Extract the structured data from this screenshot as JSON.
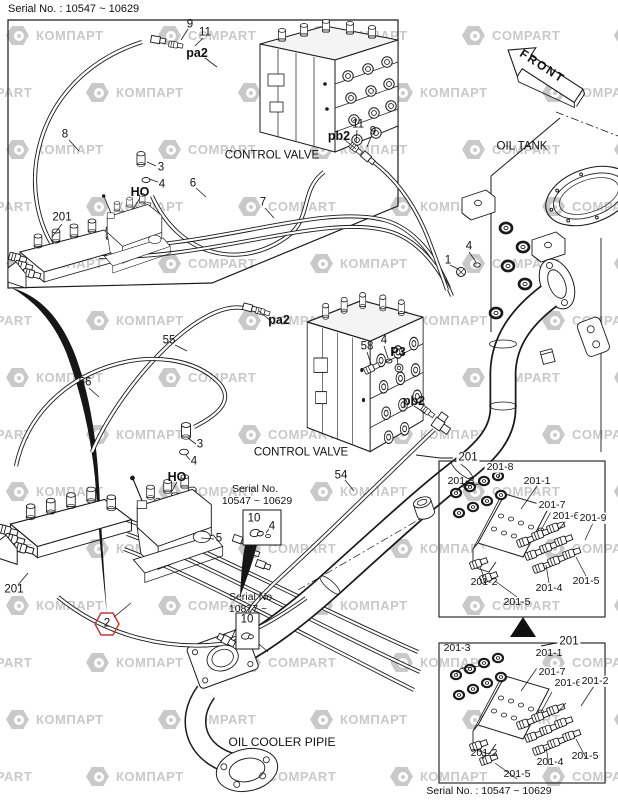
{
  "header": {
    "serial_top": "Serial No. : 10547 ~ 10629"
  },
  "front_arrow": {
    "label": "FRONT"
  },
  "watermark": {
    "words": [
      "КОМПАРТ",
      "COMPART"
    ],
    "color": "#c9c9c9"
  },
  "callouts": [
    {
      "name": "num-9-top",
      "text": "9",
      "x": 190,
      "y": 25
    },
    {
      "name": "num-11-top",
      "text": "11",
      "x": 205,
      "y": 33
    },
    {
      "name": "port-pa2-top",
      "text": "pa2",
      "x": 197,
      "y": 53,
      "b": 1
    },
    {
      "name": "num-8",
      "text": "8",
      "x": 65,
      "y": 135
    },
    {
      "name": "num-3-top",
      "text": "3",
      "x": 161,
      "y": 168
    },
    {
      "name": "num-4-top",
      "text": "4",
      "x": 162,
      "y": 185
    },
    {
      "name": "port-ho-top",
      "text": "HO",
      "x": 140,
      "y": 192,
      "b": 1
    },
    {
      "name": "num-6",
      "text": "6",
      "x": 193,
      "y": 184
    },
    {
      "name": "label-control-valve-top",
      "text": "CONTROL VALVE",
      "x": 272,
      "y": 156
    },
    {
      "name": "num-7",
      "text": "7",
      "x": 263,
      "y": 203
    },
    {
      "name": "num-201-top",
      "text": "201",
      "x": 62,
      "y": 218
    },
    {
      "name": "port-pb2-top",
      "text": "pb2",
      "x": 339,
      "y": 136,
      "b": 1
    },
    {
      "name": "num-11-top2",
      "text": "11",
      "x": 358,
      "y": 125
    },
    {
      "name": "num-9-top2",
      "text": "9",
      "x": 373,
      "y": 132
    },
    {
      "name": "label-oil-tank",
      "text": "OIL TANK",
      "x": 522,
      "y": 147
    },
    {
      "name": "num-4-tank",
      "text": "4",
      "x": 469,
      "y": 247
    },
    {
      "name": "num-1-tank",
      "text": "1",
      "x": 448,
      "y": 261
    },
    {
      "name": "port-pa2-mid",
      "text": "pa2",
      "x": 279,
      "y": 320,
      "b": 1
    },
    {
      "name": "num-55",
      "text": "55",
      "x": 169,
      "y": 341
    },
    {
      "name": "num-58",
      "text": "58",
      "x": 367,
      "y": 347
    },
    {
      "name": "num-4-58",
      "text": "4",
      "x": 384,
      "y": 341
    },
    {
      "name": "port-p3",
      "text": "P3",
      "x": 398,
      "y": 352,
      "b": 1
    },
    {
      "name": "port-pb2-mid",
      "text": "pb2",
      "x": 414,
      "y": 401,
      "b": 1
    },
    {
      "name": "num-56",
      "text": "56",
      "x": 85,
      "y": 383
    },
    {
      "name": "num-3-mid",
      "text": "3",
      "x": 200,
      "y": 445
    },
    {
      "name": "num-4-mid",
      "text": "4",
      "x": 194,
      "y": 462
    },
    {
      "name": "port-ho-mid",
      "text": "HO",
      "x": 177,
      "y": 477,
      "b": 1
    },
    {
      "name": "label-control-valve-mid",
      "text": "CONTROL VALVE",
      "x": 301,
      "y": 453
    },
    {
      "name": "num-54",
      "text": "54",
      "x": 341,
      "y": 476
    },
    {
      "name": "num-5",
      "text": "5",
      "x": 219,
      "y": 539
    },
    {
      "name": "num-201-mid",
      "text": "201",
      "x": 14,
      "y": 590
    },
    {
      "name": "num-2-hex",
      "text": "2",
      "x": 107,
      "y": 624
    },
    {
      "name": "label-oil-cooler-pipe",
      "text": "OIL COOLER PIPIE",
      "x": 282,
      "y": 742,
      "s": 12
    },
    {
      "name": "sb1-serial-line1",
      "text": "Serial No.",
      "x": 255,
      "y": 489,
      "s": 10.5
    },
    {
      "name": "sb1-serial-line2",
      "text": "10547 ~ 10629",
      "x": 257,
      "y": 501,
      "s": 10.5
    },
    {
      "name": "sb1-num-10",
      "text": "10",
      "x": 254,
      "y": 519
    },
    {
      "name": "sb1-num-4",
      "text": "4",
      "x": 272,
      "y": 527
    },
    {
      "name": "sb2-serial-line1",
      "text": "Serial No.",
      "x": 252,
      "y": 597,
      "s": 10.5
    },
    {
      "name": "sb2-serial-line2",
      "text": "10877 ~",
      "x": 248,
      "y": 609,
      "s": 10.5
    },
    {
      "name": "sb2-num-10",
      "text": "10",
      "x": 247,
      "y": 620
    },
    {
      "name": "boxa-201",
      "text": "201",
      "x": 468,
      "y": 458,
      "bg": 1
    },
    {
      "name": "boxa-201-8",
      "text": "201-8",
      "x": 500,
      "y": 467,
      "s": 10.5,
      "bg": 1
    },
    {
      "name": "boxa-201-3",
      "text": "201-3",
      "x": 461,
      "y": 481,
      "s": 10.5
    },
    {
      "name": "boxa-201-1",
      "text": "201-1",
      "x": 537,
      "y": 481,
      "s": 10.5
    },
    {
      "name": "boxa-201-7",
      "text": "201-7",
      "x": 552,
      "y": 505,
      "s": 10.5,
      "bg": 1
    },
    {
      "name": "boxa-201-6",
      "text": "201-6",
      "x": 566,
      "y": 516,
      "s": 10.5,
      "bg": 1
    },
    {
      "name": "boxa-201-9",
      "text": "201-9",
      "x": 593,
      "y": 518,
      "s": 10.5,
      "bg": 1
    },
    {
      "name": "boxa-201-2",
      "text": "201-2",
      "x": 484,
      "y": 582,
      "s": 10.5
    },
    {
      "name": "boxa-201-4",
      "text": "201-4",
      "x": 549,
      "y": 588,
      "s": 10.5
    },
    {
      "name": "boxa-201-5-right",
      "text": "201-5",
      "x": 586,
      "y": 581,
      "s": 10.5
    },
    {
      "name": "boxa-201-5-bottom",
      "text": "201-5",
      "x": 517,
      "y": 602,
      "s": 10.5
    },
    {
      "name": "boxb-201",
      "text": "201",
      "x": 569,
      "y": 642,
      "bg": 1
    },
    {
      "name": "boxb-201-3",
      "text": "201-3",
      "x": 457,
      "y": 648,
      "s": 10.5
    },
    {
      "name": "boxb-201-1",
      "text": "201-1",
      "x": 549,
      "y": 653,
      "s": 10.5
    },
    {
      "name": "boxb-201-7",
      "text": "201-7",
      "x": 552,
      "y": 672,
      "s": 10.5,
      "bg": 1
    },
    {
      "name": "boxb-201-6",
      "text": "201-6",
      "x": 568,
      "y": 683,
      "s": 10.5,
      "bg": 1
    },
    {
      "name": "boxb-201-2-topright",
      "text": "201-2",
      "x": 595,
      "y": 681,
      "s": 10.5,
      "bg": 1
    },
    {
      "name": "boxb-201-2-bottomleft",
      "text": "201-2",
      "x": 484,
      "y": 753,
      "s": 10.5
    },
    {
      "name": "boxb-201-4",
      "text": "201-4",
      "x": 550,
      "y": 762,
      "s": 10.5
    },
    {
      "name": "boxb-201-5-right",
      "text": "201-5",
      "x": 585,
      "y": 756,
      "s": 10.5
    },
    {
      "name": "boxb-201-5-bottom",
      "text": "201-5",
      "x": 517,
      "y": 774,
      "s": 10.5
    },
    {
      "name": "serial-bottom",
      "text": "Serial No. : 10547 ~ 10629",
      "x": 489,
      "y": 791,
      "s": 10.5
    }
  ]
}
